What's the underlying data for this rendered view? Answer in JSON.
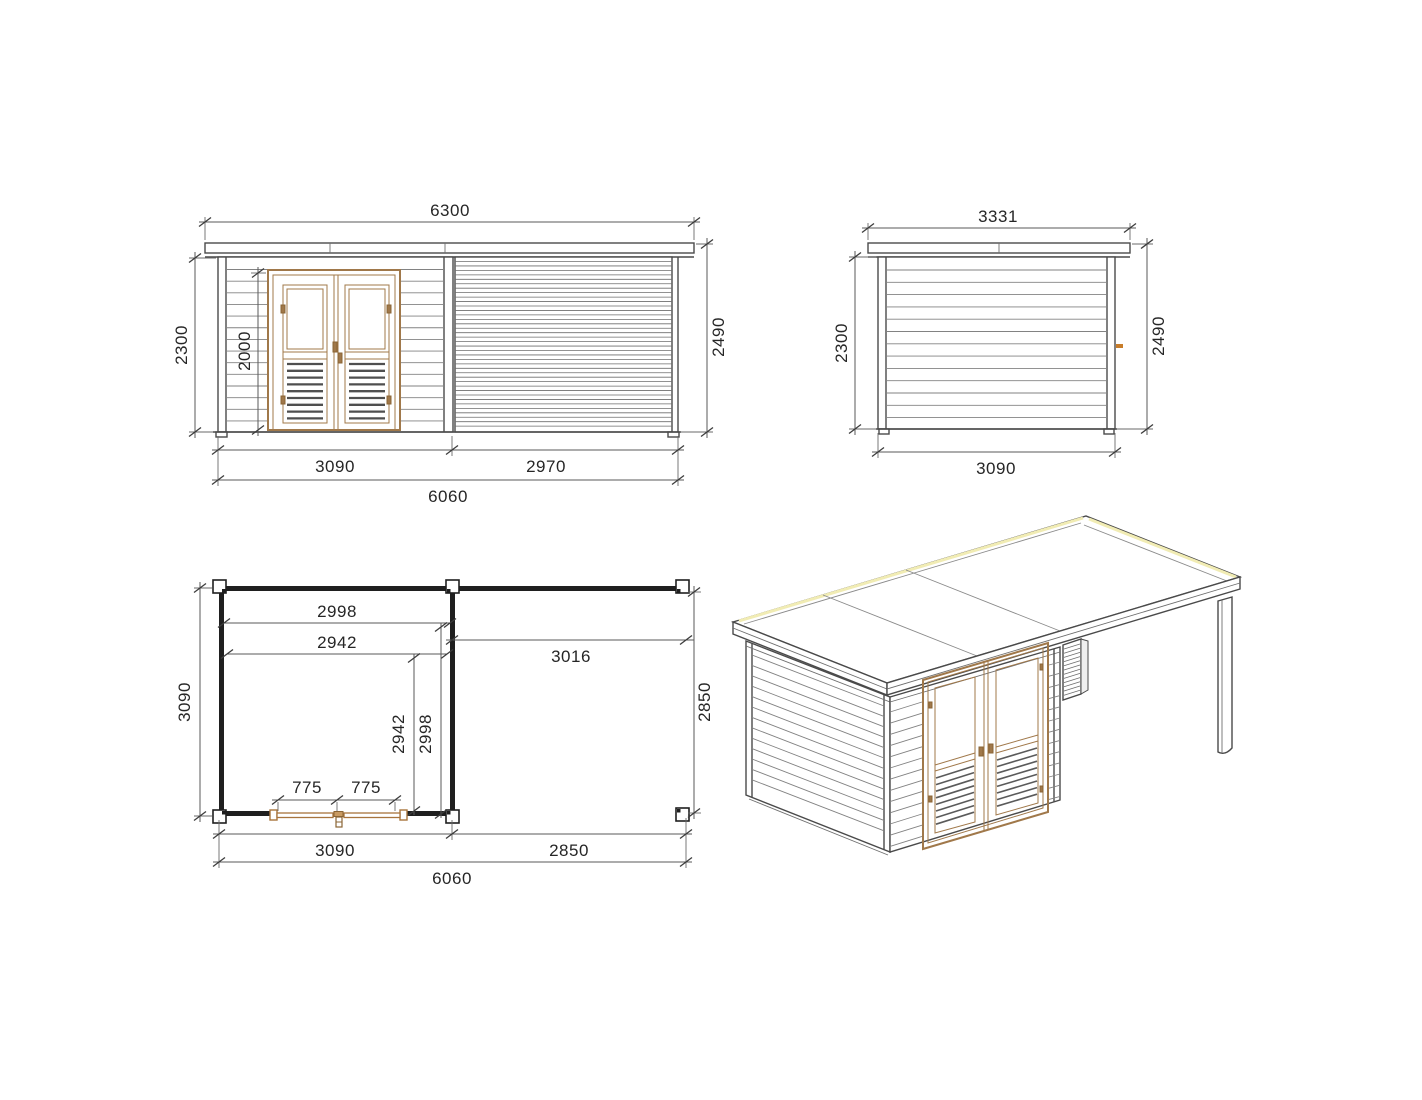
{
  "drawing_type": "log-cabin-with-canopy-technical-drawing",
  "colors": {
    "background": "#ffffff",
    "line": "#4a4a4a",
    "plan_wall": "#1f1f1f",
    "door_wood": "#a0784a",
    "door_wood_dark": "#8a6434",
    "handle_orange": "#c87d2a",
    "roof_highlight": "#f1ecb4",
    "dimension_text": "#262626"
  },
  "front_elevation": {
    "dims": {
      "roof_width": "6300",
      "wall_height": "2300",
      "door_height": "2000",
      "overall_height": "2490",
      "cabin_width": "3090",
      "canopy_width": "2970",
      "overall_width": "6060"
    }
  },
  "side_elevation": {
    "dims": {
      "roof_depth": "3331",
      "wall_height": "2300",
      "overall_height": "2490",
      "wall_depth": "3090"
    }
  },
  "floor_plan": {
    "dims": {
      "depth_left": "3090",
      "inner_width": "2998",
      "inner_post_width": "2942",
      "canopy_opening": "3016",
      "inner_depth_a": "2942",
      "inner_depth_b": "2998",
      "canopy_depth_right": "2850",
      "door_leaf_left": "775",
      "door_leaf_right": "775",
      "cabin_width": "3090",
      "canopy_width": "2850",
      "overall_width": "6060"
    }
  }
}
